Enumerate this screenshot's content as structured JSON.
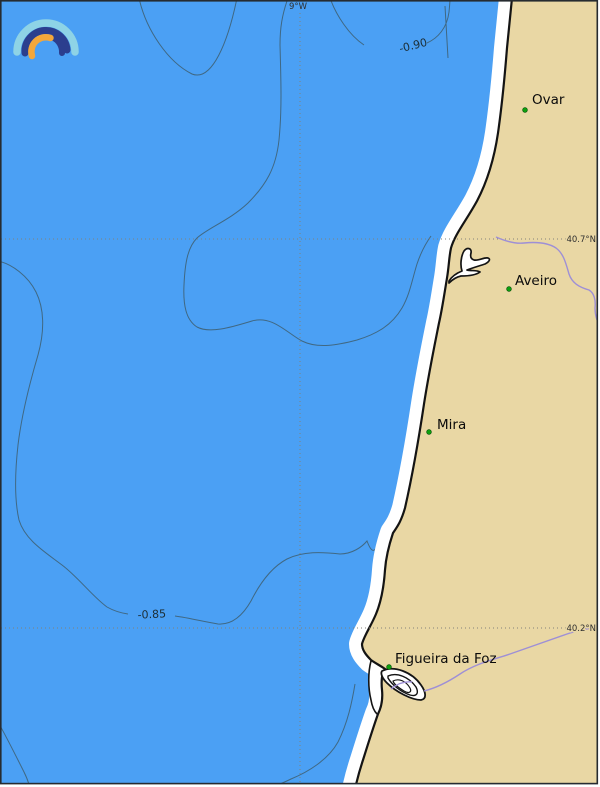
{
  "logo": {
    "name": "rainbow-arcs-logo",
    "colors": {
      "outer_arc": "#8ed3e6",
      "middle_arc": "#2b3e8e",
      "inner_arc": "#f4a73a"
    }
  },
  "graticule": {
    "meridian": "9°W",
    "parallels": [
      "40.7°N",
      "40.2°N"
    ]
  },
  "contours": {
    "labels": [
      "-0.90",
      "-0.85"
    ]
  },
  "cities": [
    {
      "name": "Ovar"
    },
    {
      "name": "Aveiro"
    },
    {
      "name": "Mira"
    },
    {
      "name": "Figueira da Foz"
    }
  ],
  "colors": {
    "ocean": "#4ba0f4",
    "land": "#e9d7a4",
    "surf_band": "#ffffff",
    "coastline": "#141414",
    "contour_line": "#3d5a66",
    "river": "#9e8fd6",
    "gridline": "#82827a",
    "city_marker": "#0da00d"
  }
}
